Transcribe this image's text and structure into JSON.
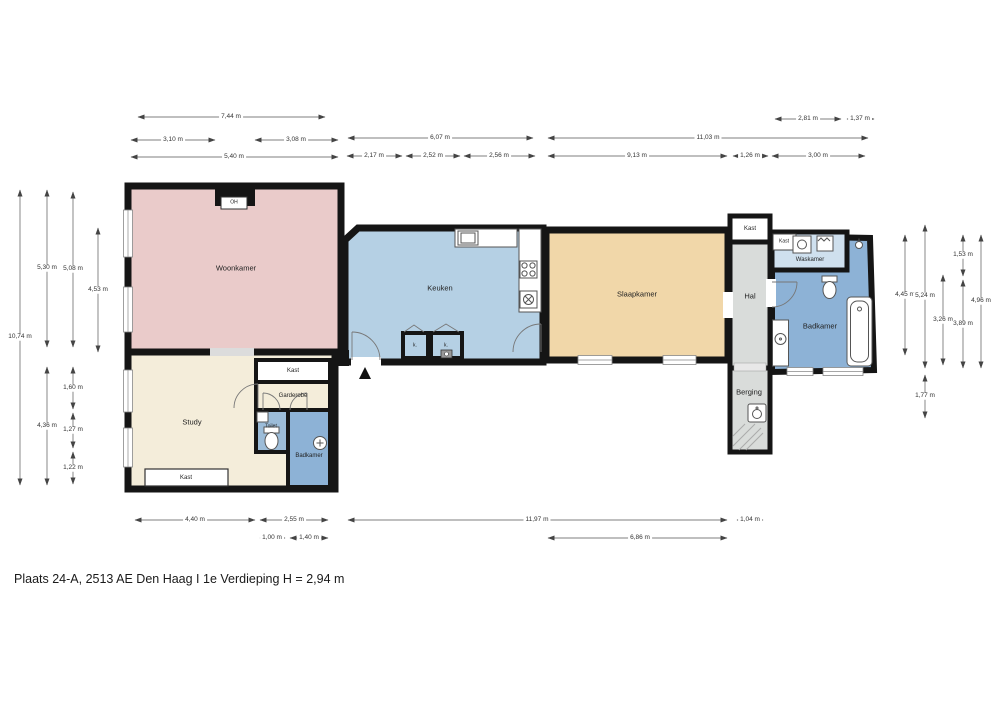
{
  "title": "Plaats 24-A, 2513 AE Den Haag  I  1e Verdieping H = 2,94 m",
  "rooms": {
    "woonkamer": "Woonkamer",
    "keuken": "Keuken",
    "slaapkamer": "Slaapkamer",
    "study": "Study",
    "kast_study": "Kast",
    "kast_cluster": "Kast",
    "garderobe": "Garderobe",
    "toilet": "Toilet",
    "badkamer_left": "Badkamer",
    "oh": "OH",
    "k1": "k.",
    "k2": "k.",
    "kast_hal": "Kast",
    "hal": "Hal",
    "berging": "Berging",
    "kast_waskamer": "Kast",
    "waskamer": "Waskamer",
    "badkamer_right": "Badkamer"
  },
  "dims_top": [
    "7,44 m",
    "3,10 m",
    "3,08 m",
    "5,40 m",
    "6,07 m",
    "2,17 m",
    "2,52 m",
    "2,56 m",
    "11,03 m",
    "9,13 m",
    "1,26 m",
    "3,00 m",
    "2,81 m",
    "1,37 m"
  ],
  "dims_left": [
    "10,74 m",
    "5,30 m",
    "4,36 m",
    "5,08 m",
    "1,60 m",
    "1,27 m",
    "1,22 m",
    "4,53 m"
  ],
  "dims_right": [
    "4,45 m",
    "5,24 m",
    "1,77 m",
    "3,26 m",
    "1,53 m",
    "3,89 m",
    "4,96 m"
  ],
  "dims_bottom": [
    "4,40 m",
    "2,55 m",
    "11,97 m",
    "1,04 m",
    "1,00 m",
    "1,40 m",
    "6,86 m"
  ],
  "colors": {
    "woonkamer": "#eacbca",
    "keuken": "#b5d0e4",
    "slaapkamer": "#f1d7a9",
    "study": "#f4edda",
    "waskamer": "#cfe0ee",
    "badkamer": "#8db2d6",
    "toilet": "#9cbcd8",
    "hal": "#d9dcda",
    "kast": "#ffffff",
    "wall": "#151515"
  }
}
